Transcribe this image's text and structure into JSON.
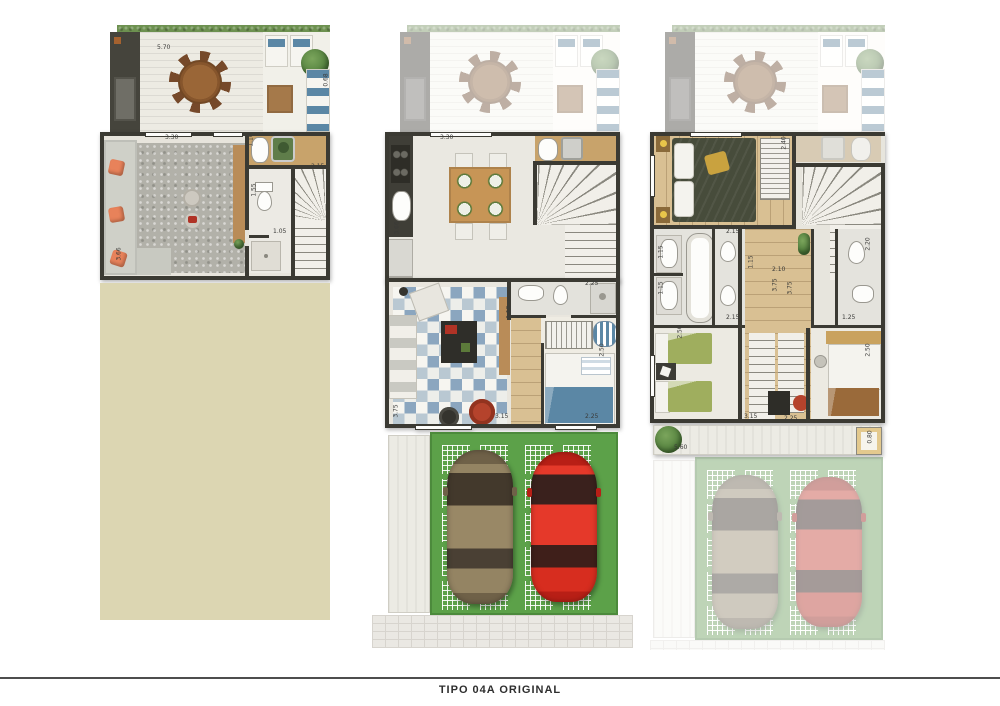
{
  "footer": {
    "title": "TIPO 04A ORIGINAL"
  },
  "colors": {
    "wall": "#3b3a33",
    "lawn": "#5ca149",
    "beige": "#dcd6b2",
    "hedge": "#6d9150",
    "wood": "#d9c093",
    "tileBlue": "#8ba6bf",
    "carRed": "#d92b1f",
    "carGold": "#8f805f",
    "accentOrange": "#e8825a",
    "bedGreen": "#9fae5e",
    "bedBlue": "#5b87a5",
    "footerText": "#2e2e2e"
  },
  "plans": [
    {
      "dims": [
        {
          "t": "5.70",
          "x": 62,
          "y": 20,
          "v": 0
        },
        {
          "t": "0.68",
          "x": 225,
          "y": 52,
          "v": 1
        },
        {
          "t": "3.30",
          "x": 70,
          "y": 110,
          "v": 0
        },
        {
          "t": "1.10",
          "x": 150,
          "y": 112,
          "v": 1
        },
        {
          "t": "2.15",
          "x": 216,
          "y": 139,
          "v": 0
        },
        {
          "t": "1.55",
          "x": 153,
          "y": 162,
          "v": 1
        },
        {
          "t": "1.05",
          "x": 178,
          "y": 204,
          "v": 0
        },
        {
          "t": "3.66",
          "x": 18,
          "y": 226,
          "v": 1
        }
      ]
    },
    {
      "dims": [
        {
          "t": "3.30",
          "x": 55,
          "y": 110,
          "v": 0
        },
        {
          "t": "3.66",
          "x": 6,
          "y": 200,
          "v": 1
        },
        {
          "t": "2.25",
          "x": 200,
          "y": 256,
          "v": 0
        },
        {
          "t": "1.15",
          "x": 118,
          "y": 284,
          "v": 1
        },
        {
          "t": "2.50",
          "x": 211,
          "y": 322,
          "v": 1
        },
        {
          "t": "3.75",
          "x": 5,
          "y": 383,
          "v": 1
        },
        {
          "t": "3.15",
          "x": 110,
          "y": 389,
          "v": 0
        },
        {
          "t": "2.25",
          "x": 200,
          "y": 389,
          "v": 0
        }
      ]
    },
    {
      "dims": [
        {
          "t": "2.40",
          "x": 128,
          "y": 115,
          "v": 1
        },
        {
          "t": "2.15",
          "x": 76,
          "y": 204,
          "v": 0
        },
        {
          "t": "1.15",
          "x": 5,
          "y": 224,
          "v": 1
        },
        {
          "t": "1.15",
          "x": 5,
          "y": 260,
          "v": 1
        },
        {
          "t": "1.15",
          "x": 95,
          "y": 234,
          "v": 1
        },
        {
          "t": "2.10",
          "x": 122,
          "y": 242,
          "v": 0
        },
        {
          "t": "3.75",
          "x": 119,
          "y": 257,
          "v": 1
        },
        {
          "t": "3.75",
          "x": 134,
          "y": 260,
          "v": 1
        },
        {
          "t": "2.15",
          "x": 76,
          "y": 290,
          "v": 0
        },
        {
          "t": "2.20",
          "x": 212,
          "y": 216,
          "v": 1
        },
        {
          "t": "1.25",
          "x": 192,
          "y": 290,
          "v": 0
        },
        {
          "t": "2.50",
          "x": 24,
          "y": 304,
          "v": 1
        },
        {
          "t": "2.50",
          "x": 212,
          "y": 322,
          "v": 1
        },
        {
          "t": "3.15",
          "x": 94,
          "y": 389,
          "v": 0
        },
        {
          "t": "2.25",
          "x": 134,
          "y": 391,
          "v": 0
        },
        {
          "t": "5.60",
          "x": 24,
          "y": 420,
          "v": 0
        },
        {
          "t": "0.80",
          "x": 214,
          "y": 409,
          "v": 1
        }
      ]
    }
  ]
}
